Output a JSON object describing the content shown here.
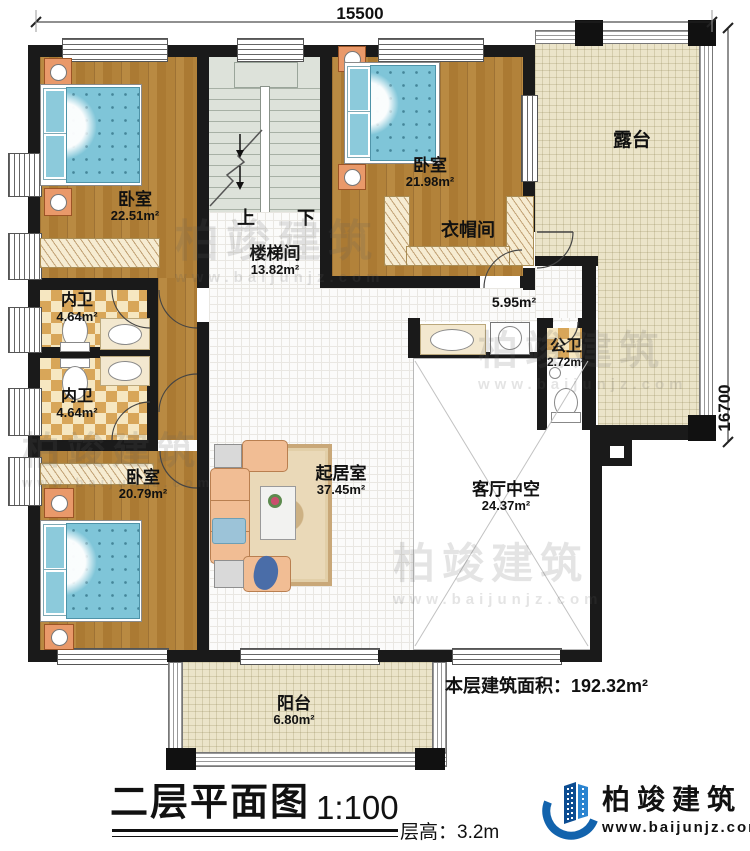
{
  "dimensions": {
    "top": "15500",
    "right": "16700"
  },
  "rooms": {
    "bedroom_tl": {
      "name": "卧室",
      "area": "22.51m²"
    },
    "stairwell": {
      "name": "楼梯间",
      "area": "13.82m²",
      "up": "上",
      "down": "下"
    },
    "bedroom_tr": {
      "name": "卧室",
      "area": "21.98m²"
    },
    "cloakroom": {
      "name": "衣帽间"
    },
    "terrace": {
      "name": "露台"
    },
    "hallway": {
      "area": "5.95m²"
    },
    "bath_upper": {
      "name": "内卫",
      "area": "4.64m²"
    },
    "bath_lower": {
      "name": "内卫",
      "area": "4.64m²"
    },
    "public_bath": {
      "name": "公卫",
      "area": "2.72m²"
    },
    "bedroom_bl": {
      "name": "卧室",
      "area": "20.79m²"
    },
    "living": {
      "name": "起居室",
      "area": "37.45m²"
    },
    "void": {
      "name": "客厅中空",
      "area": "24.37m²"
    },
    "balcony": {
      "name": "阳台",
      "area": "6.80m²"
    }
  },
  "footer": {
    "title": "二层平面图",
    "scale": "1:100",
    "floor_height": "层高：3.2m",
    "floor_area_label": "本层建筑面积：192.32m²"
  },
  "brand": {
    "name": "柏竣建筑",
    "url": "www.baijunjz.com"
  },
  "watermark": {
    "name": "柏竣建筑",
    "url": "www.baijunjz.com"
  },
  "colors": {
    "wall": "#1a1a1a",
    "wood": "#b07c35",
    "terrace": "#ebe4c9",
    "checker": "#d8a659",
    "stair": "#dde2da",
    "bed": "#7fc5d8",
    "sofa": "#f1bd94",
    "brand_blue": "#1263ad"
  }
}
